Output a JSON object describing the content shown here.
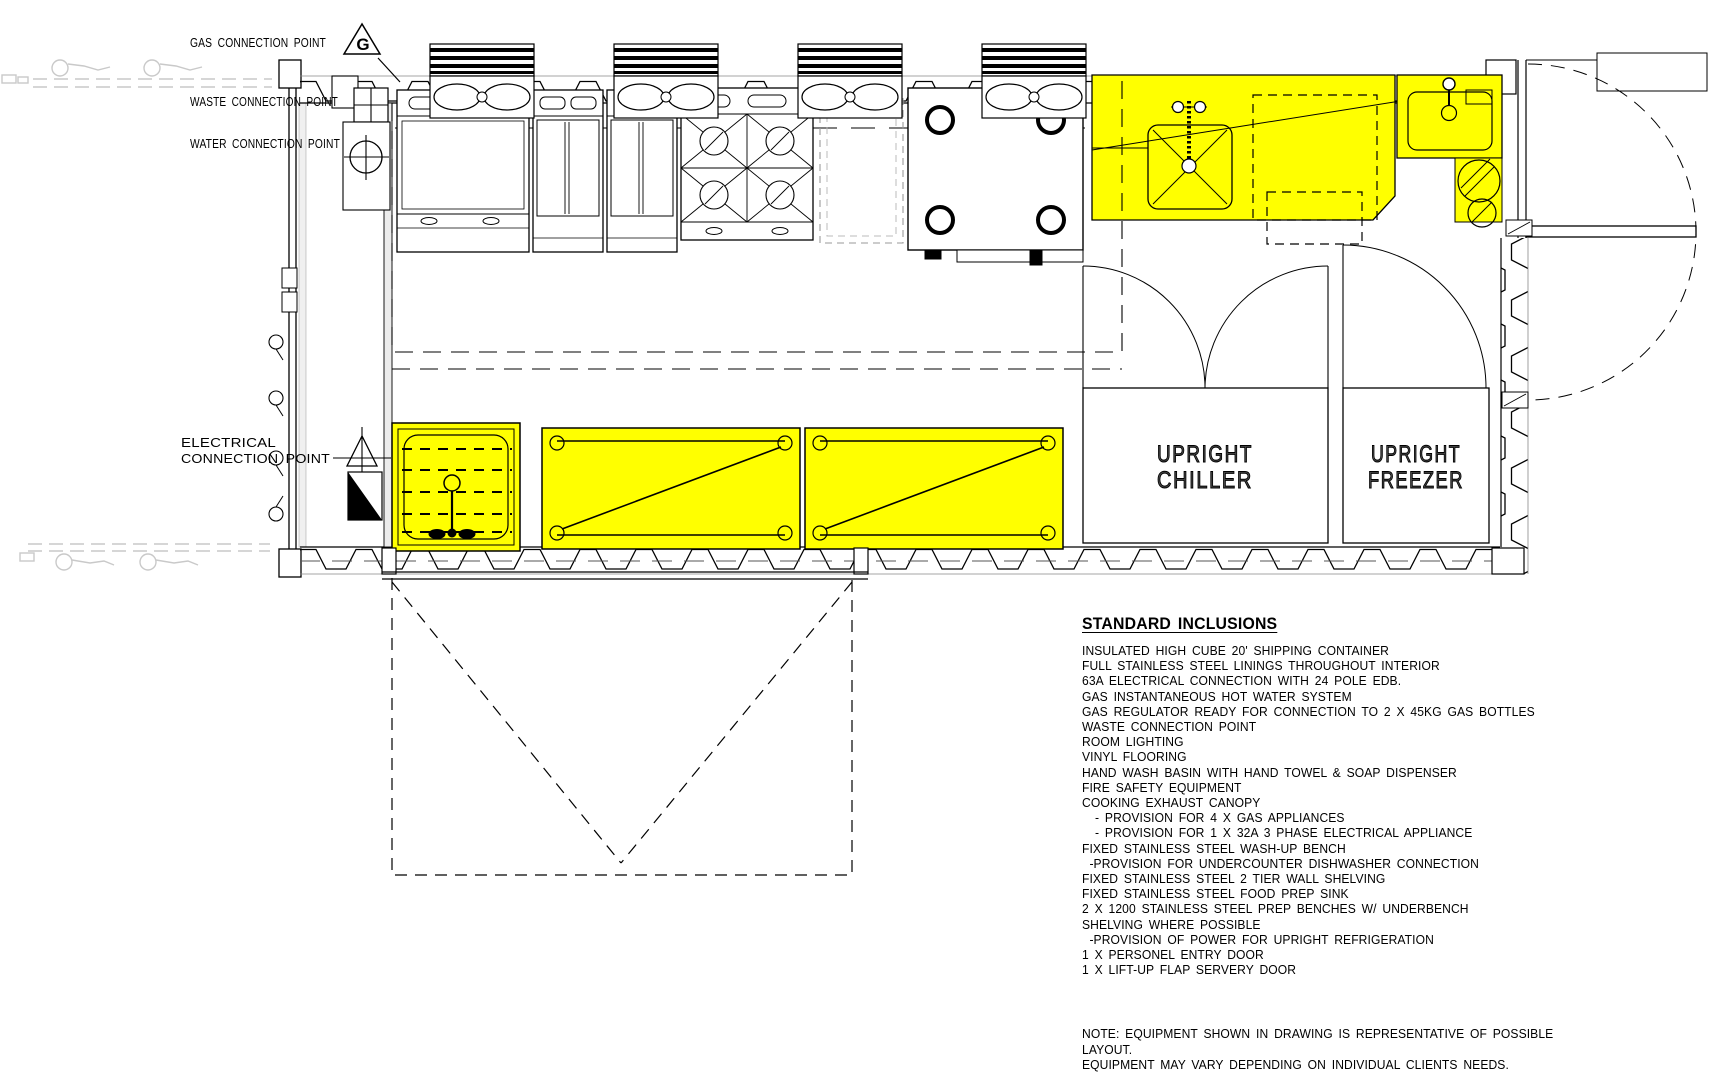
{
  "colors": {
    "highlight": "#FFFF00",
    "line": "#000000",
    "faint": "#c9c9c9"
  },
  "plan": {
    "labels": {
      "gas": "GAS CONNECTION POINT",
      "gas_symbol": "G",
      "waste": "WASTE CONNECTION POINT",
      "water": "WATER CONNECTION POINT",
      "electrical_line1": "ELECTRICAL",
      "electrical_line2": "CONNECTION POINT",
      "chiller_line1": "UPRIGHT",
      "chiller_line2": "CHILLER",
      "freezer_line1": "UPRIGHT",
      "freezer_line2": "FREEZER"
    }
  },
  "inclusions": {
    "title": "STANDARD INCLUSIONS",
    "items": [
      {
        "text": "INSULATED HIGH CUBE 20' SHIPPING CONTAINER",
        "indent": 0
      },
      {
        "text": "FULL STAINLESS STEEL LININGS THROUGHOUT INTERIOR",
        "indent": 0
      },
      {
        "text": "63A ELECTRICAL CONNECTION WITH 24 POLE EDB.",
        "indent": 0
      },
      {
        "text": "GAS INSTANTANEOUS HOT WATER SYSTEM",
        "indent": 0
      },
      {
        "text": "GAS REGULATOR READY FOR CONNECTION TO 2 X 45KG GAS BOTTLES",
        "indent": 0
      },
      {
        "text": "WASTE CONNECTION POINT",
        "indent": 0
      },
      {
        "text": "ROOM LIGHTING",
        "indent": 0
      },
      {
        "text": "VINYL FLOORING",
        "indent": 0
      },
      {
        "text": "HAND WASH BASIN WITH HAND TOWEL & SOAP DISPENSER",
        "indent": 0
      },
      {
        "text": "FIRE SAFETY EQUIPMENT",
        "indent": 0
      },
      {
        "text": "COOKING EXHAUST CANOPY",
        "indent": 0
      },
      {
        "text": "- PROVISION FOR 4 X GAS APPLIANCES",
        "indent": 14
      },
      {
        "text": "- PROVISION FOR 1 X 32A 3 PHASE ELECTRICAL APPLIANCE",
        "indent": 14
      },
      {
        "text": "FIXED STAINLESS STEEL WASH-UP BENCH",
        "indent": 0
      },
      {
        "text": "-PROVISION FOR UNDERCOUNTER DISHWASHER CONNECTION",
        "indent": 8
      },
      {
        "text": "FIXED STAINLESS STEEL 2 TIER WALL SHELVING",
        "indent": 0
      },
      {
        "text": "FIXED STAINLESS STEEL FOOD PREP SINK",
        "indent": 0
      },
      {
        "text": "2 X 1200 STAINLESS STEEL PREP BENCHES W/ UNDERBENCH",
        "indent": 0
      },
      {
        "text": "SHELVING WHERE POSSIBLE",
        "indent": 0
      },
      {
        "text": "-PROVISION OF POWER FOR UPRIGHT REFRIGERATION",
        "indent": 8
      },
      {
        "text": "1 X PERSONEL ENTRY DOOR",
        "indent": 0
      },
      {
        "text": "1 X LIFT-UP FLAP SERVERY DOOR",
        "indent": 0
      }
    ]
  },
  "note": {
    "line1": "NOTE: EQUIPMENT SHOWN IN DRAWING IS REPRESENTATIVE OF POSSIBLE LAYOUT.",
    "line2": "EQUIPMENT MAY VARY DEPENDING ON INDIVIDUAL CLIENTS NEEDS."
  }
}
